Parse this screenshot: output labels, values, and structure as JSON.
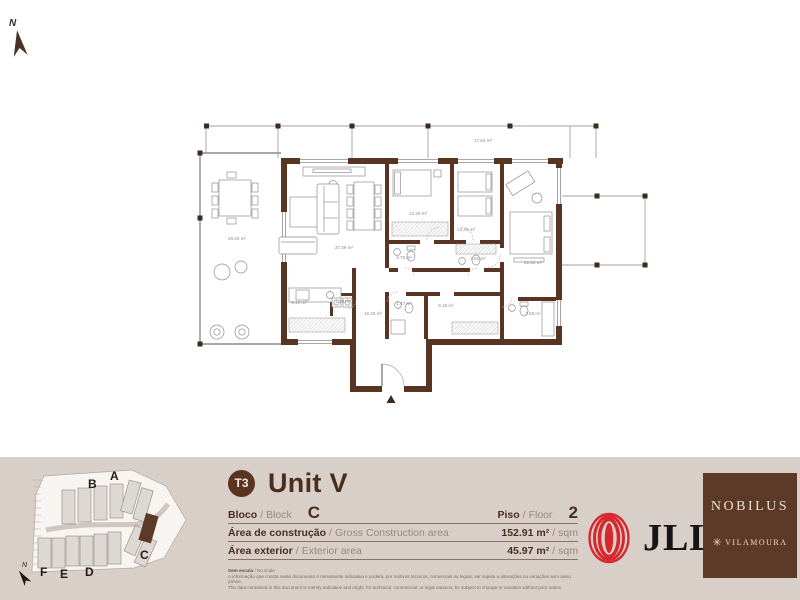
{
  "north_arrow": {
    "label": "N"
  },
  "plan": {
    "areas": [
      "28.34 m²",
      "17.63 m²",
      "37.39 m²",
      "12.29 m²",
      "13.49 m²",
      "22.34 m²",
      "2.75 m²",
      "3.82 m²",
      "9.40 m²",
      "1.70 m²",
      "16.33 m²",
      "1.47 m²",
      "5.18 m²",
      "3.68 m²"
    ]
  },
  "site_map": {
    "letters": [
      "A",
      "B",
      "C",
      "D",
      "E",
      "F"
    ],
    "north_label": "N"
  },
  "info": {
    "badge": "T3",
    "title": "Unit V",
    "sep": "/",
    "bloco_pt": "Bloco",
    "bloco_en": "Block",
    "bloco_value": "C",
    "piso_pt": "Piso",
    "piso_en": "Floor",
    "piso_value": "2",
    "constr_pt": "Área de construção",
    "constr_en": "Gross Construction area",
    "constr_value": "152.91 m²",
    "constr_unit": "sqm",
    "ext_pt": "Área exterior",
    "ext_en": "Exterior area",
    "ext_value": "45.97 m²",
    "ext_unit": "sqm",
    "disclaimer_scale_pt": "Sem escala",
    "disclaimer_scale_en": "No scale",
    "disclaimer_pt": "A informação que consta neste documento é meramente indicativa e poderá, por motivos técnicos, comerciais ou legais, ser sujeita a alterações ou variações sem aviso prévio.",
    "disclaimer_en": "The data contained in this document is merely indicative and might, for technical, commercial, or legal reasons, be subject to change or variation without prior notice."
  },
  "brands": {
    "jll": "JLL",
    "nobilus": "NOBILUS",
    "nobilus_star": "✳",
    "nobilus_sub": "VILAMOURA"
  },
  "colors": {
    "wall_brown": "#5a3423",
    "accent_brown": "#4a2d1c",
    "footer_bg": "#d8cfc8",
    "jll_red": "#d7282f",
    "nobilus_bg": "#5d3a28"
  }
}
